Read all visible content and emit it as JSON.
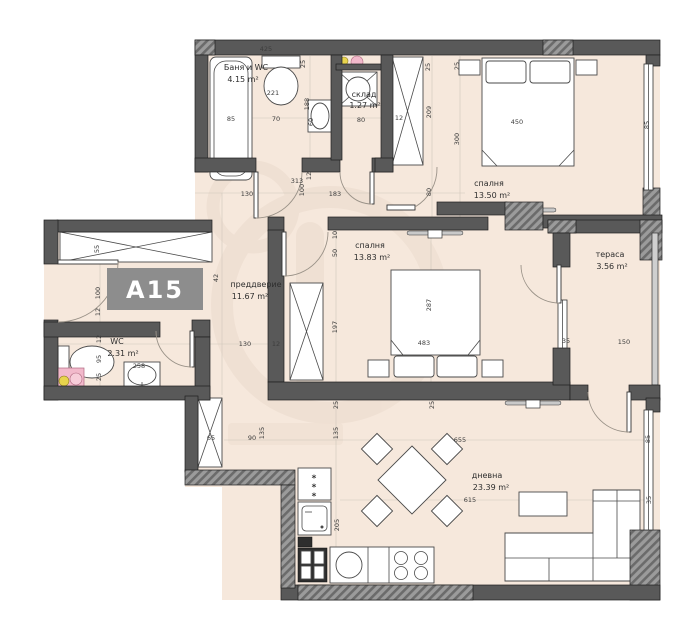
{
  "unit": {
    "label": "A15"
  },
  "colors": {
    "floor": "#f6e8dc",
    "wall": "#595959",
    "hatchBase": "#9b9b9b",
    "hatchLine": "#6b6b6b",
    "accentPink": "#f2b9cb",
    "accentYellow": "#e8d44d",
    "badge": "#8d8d8d",
    "watermark": "#ead9cb",
    "dimText": "#3d3d3d"
  },
  "rooms": {
    "bath": {
      "label": "Баня и WC",
      "area": "4.15 m²"
    },
    "storage": {
      "label": "склад",
      "area": "1.27 m²"
    },
    "bedroom1": {
      "label": "спалня",
      "area": "13.50 m²"
    },
    "bedroom2": {
      "label": "спалня",
      "area": "13.83 m²"
    },
    "terrace": {
      "label": "тераса",
      "area": "3.56 m²"
    },
    "hall": {
      "label": "преддверие",
      "area": "11.67 m²"
    },
    "wc": {
      "label": "WC",
      "area": "2.31 m²"
    },
    "living": {
      "label": "дневна",
      "area": "23.39 m²"
    }
  },
  "dim_labels": [
    {
      "t": "425",
      "x": 266,
      "y": 51,
      "v": false,
      "c": "#e0e0e0"
    },
    {
      "t": "25",
      "x": 305,
      "y": 64,
      "v": true
    },
    {
      "t": "221",
      "x": 273,
      "y": 95,
      "v": false
    },
    {
      "t": "188",
      "x": 309,
      "y": 104,
      "v": true
    },
    {
      "t": "85",
      "x": 231,
      "y": 121,
      "v": false
    },
    {
      "t": "70",
      "x": 276,
      "y": 121,
      "v": false
    },
    {
      "t": "60",
      "x": 313,
      "y": 122,
      "v": true
    },
    {
      "t": "80",
      "x": 361,
      "y": 122,
      "v": false
    },
    {
      "t": "25",
      "x": 430,
      "y": 67,
      "v": true
    },
    {
      "t": "25",
      "x": 459,
      "y": 66,
      "v": true
    },
    {
      "t": "209",
      "x": 431,
      "y": 112,
      "v": true
    },
    {
      "t": "12",
      "x": 399,
      "y": 120,
      "v": false
    },
    {
      "t": "300",
      "x": 459,
      "y": 139,
      "v": true
    },
    {
      "t": "450",
      "x": 517,
      "y": 124,
      "v": false
    },
    {
      "t": "85",
      "x": 649,
      "y": 125,
      "v": true
    },
    {
      "t": "80",
      "x": 431,
      "y": 192,
      "v": true
    },
    {
      "t": "313",
      "x": 297,
      "y": 183,
      "v": false
    },
    {
      "t": "12",
      "x": 311,
      "y": 176,
      "v": true
    },
    {
      "t": "100",
      "x": 304,
      "y": 190,
      "v": true
    },
    {
      "t": "130",
      "x": 247,
      "y": 196,
      "v": false
    },
    {
      "t": "183",
      "x": 335,
      "y": 196,
      "v": false
    },
    {
      "t": "42",
      "x": 218,
      "y": 278,
      "v": true
    },
    {
      "t": "130",
      "x": 245,
      "y": 346,
      "v": false
    },
    {
      "t": "12",
      "x": 276,
      "y": 346,
      "v": false
    },
    {
      "t": "55",
      "x": 99,
      "y": 249,
      "v": true
    },
    {
      "t": "100",
      "x": 100,
      "y": 293,
      "v": true
    },
    {
      "t": "12",
      "x": 100,
      "y": 312,
      "v": true
    },
    {
      "t": "12",
      "x": 101,
      "y": 339,
      "v": true
    },
    {
      "t": "95",
      "x": 101,
      "y": 359,
      "v": true
    },
    {
      "t": "25",
      "x": 101,
      "y": 377,
      "v": true
    },
    {
      "t": "258",
      "x": 139,
      "y": 368,
      "v": false
    },
    {
      "t": "65",
      "x": 211,
      "y": 440,
      "v": false
    },
    {
      "t": "90",
      "x": 252,
      "y": 440,
      "v": false
    },
    {
      "t": "135",
      "x": 264,
      "y": 433,
      "v": true
    },
    {
      "t": "10",
      "x": 337,
      "y": 235,
      "v": true
    },
    {
      "t": "50",
      "x": 337,
      "y": 253,
      "v": true
    },
    {
      "t": "197",
      "x": 337,
      "y": 327,
      "v": true
    },
    {
      "t": "287",
      "x": 431,
      "y": 305,
      "v": true
    },
    {
      "t": "483",
      "x": 424,
      "y": 345,
      "v": false
    },
    {
      "t": "25",
      "x": 338,
      "y": 405,
      "v": true
    },
    {
      "t": "25",
      "x": 434,
      "y": 405,
      "v": true
    },
    {
      "t": "35",
      "x": 566,
      "y": 343,
      "v": false
    },
    {
      "t": "150",
      "x": 624,
      "y": 344,
      "v": false
    },
    {
      "t": "135",
      "x": 338,
      "y": 433,
      "v": true
    },
    {
      "t": "655",
      "x": 460,
      "y": 442,
      "v": false
    },
    {
      "t": "615",
      "x": 470,
      "y": 502,
      "v": false
    },
    {
      "t": "205",
      "x": 339,
      "y": 525,
      "v": true
    },
    {
      "t": "85",
      "x": 650,
      "y": 439,
      "v": true
    },
    {
      "t": "35",
      "x": 651,
      "y": 500,
      "v": true
    }
  ]
}
